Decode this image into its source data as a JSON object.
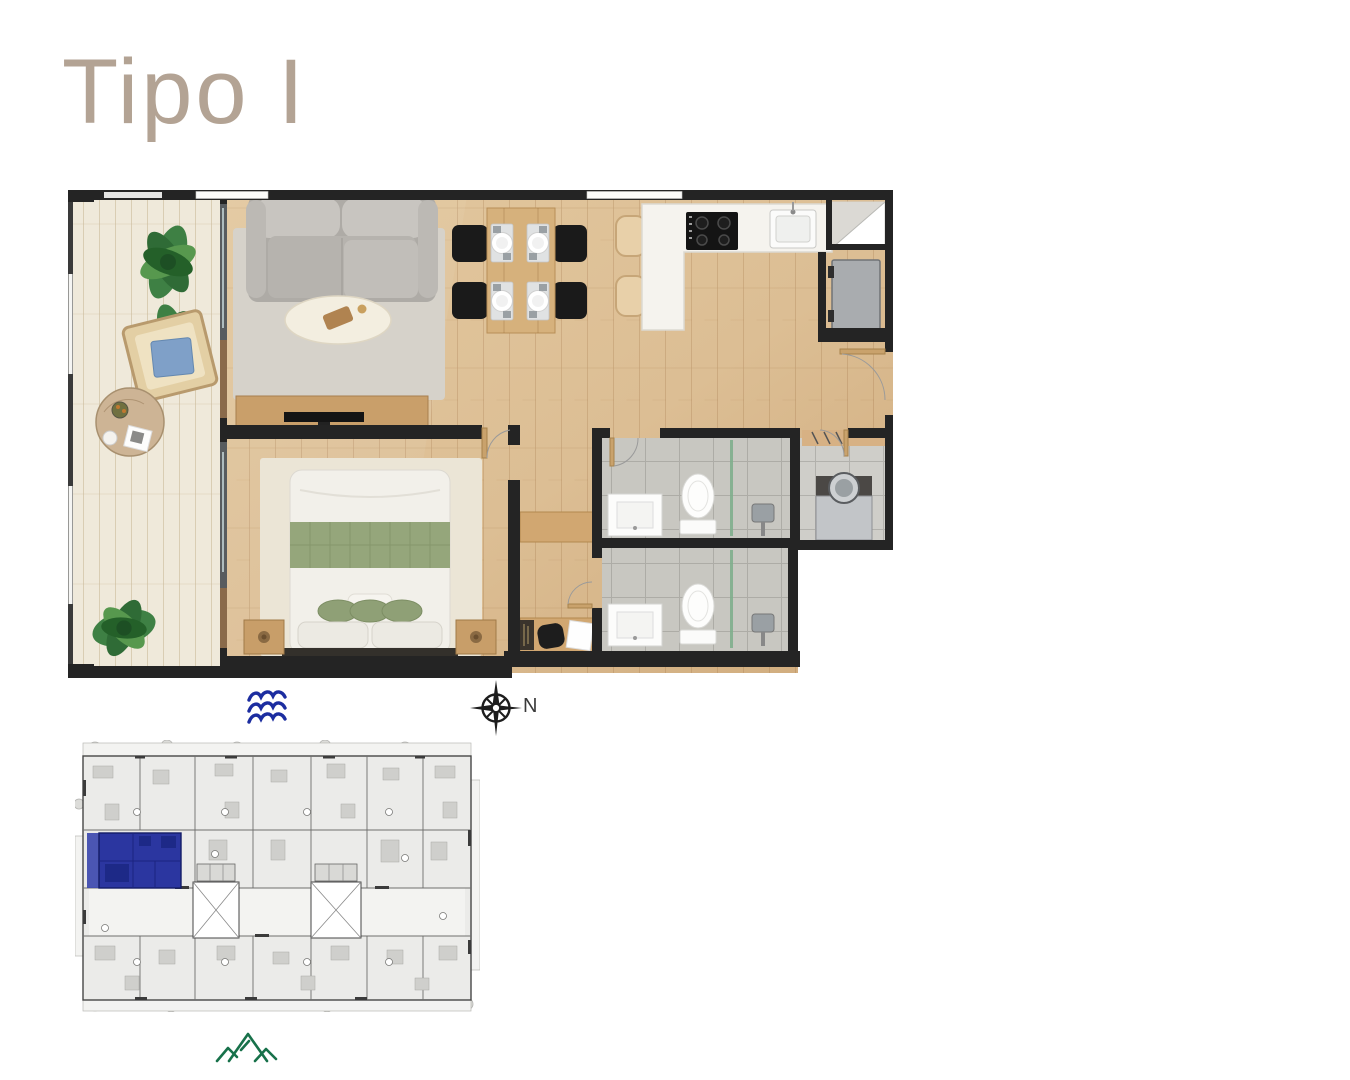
{
  "page": {
    "title": "Tipo I"
  },
  "compass": {
    "north_label": "N"
  },
  "icons": {
    "waves": "waves-icon",
    "compass": "compass-rose-icon",
    "mountains": "mountains-icon"
  },
  "colors": {
    "title": "#b3a394",
    "waves_blue": "#1c2da0",
    "mountain_green": "#17714a",
    "compass_ink": "#1d1d1d",
    "key_plan_highlight": "#2b36a0",
    "plan_wall": "#242424",
    "plan_wood_floor": "#dcbe94",
    "plan_balcony_floor": "#efe9da"
  }
}
